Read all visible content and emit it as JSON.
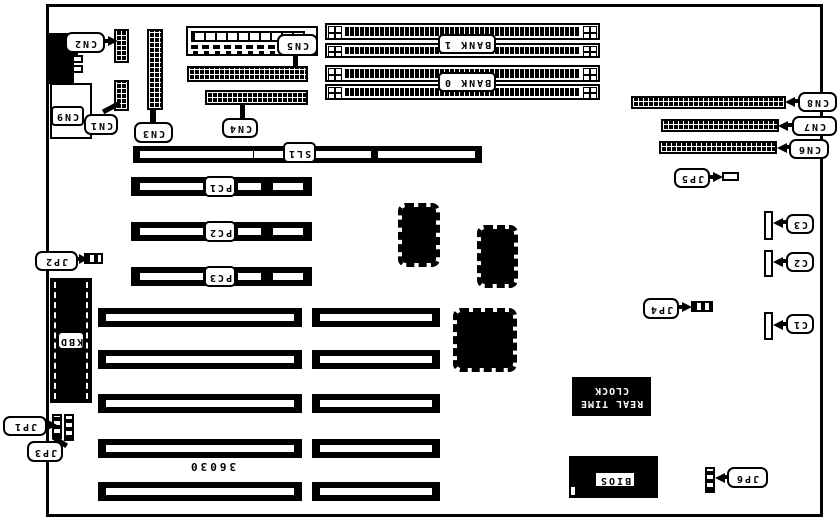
{
  "board": {
    "number": "36030",
    "colors": {
      "ink": "#000000",
      "paper": "#ffffff"
    },
    "connectors": {
      "cn1": "CN1",
      "cn2": "CN2",
      "cn3": "CN3",
      "cn4": "CN4",
      "cn5": "CN5",
      "cn6": "CN6",
      "cn7": "CN7",
      "cn8": "CN8",
      "cn9": "CN9"
    },
    "jumpers": {
      "jp1": "JP1",
      "jp2": "JP2",
      "jp3": "JP3",
      "jp4": "JP4",
      "jp5": "JP5",
      "jp6": "JP6"
    },
    "slots": {
      "sl1": "SL1",
      "pc1": "PC1",
      "pc2": "PC2",
      "pc3": "PC3"
    },
    "memory": {
      "bank0": "BANK 0",
      "bank1": "BANK 1"
    },
    "chips": {
      "kbd": "KBD",
      "bios": "BIOS",
      "rtc_line1": "REAL TIME",
      "rtc_line2": "CLOCK"
    },
    "capacitors": {
      "c1": "C1",
      "c2": "C2",
      "c3": "C3"
    }
  }
}
